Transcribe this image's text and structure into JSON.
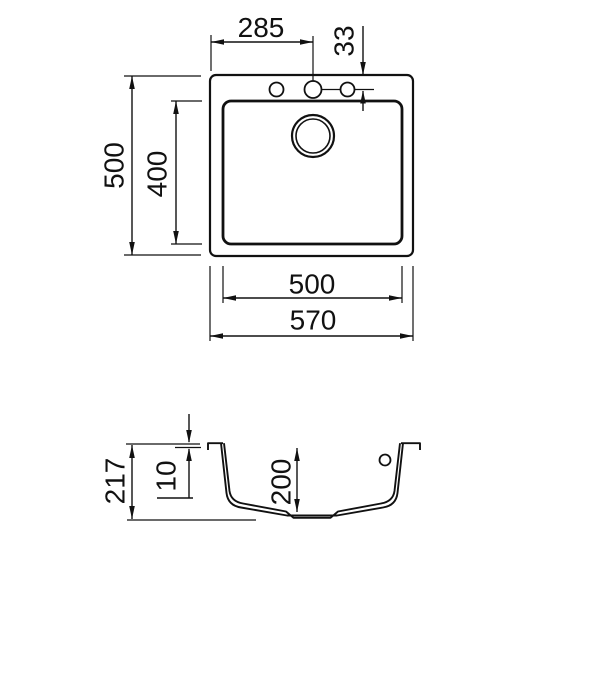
{
  "top_view": {
    "dim_hole_span": "285",
    "dim_hole_offset": "33",
    "dim_outer_depth": "500",
    "dim_bowl_depth": "400",
    "dim_bowl_width": "500",
    "dim_outer_width": "570"
  },
  "side_view": {
    "dim_total_height": "217",
    "dim_rim_thickness": "10",
    "dim_bowl_inner_depth": "200"
  }
}
